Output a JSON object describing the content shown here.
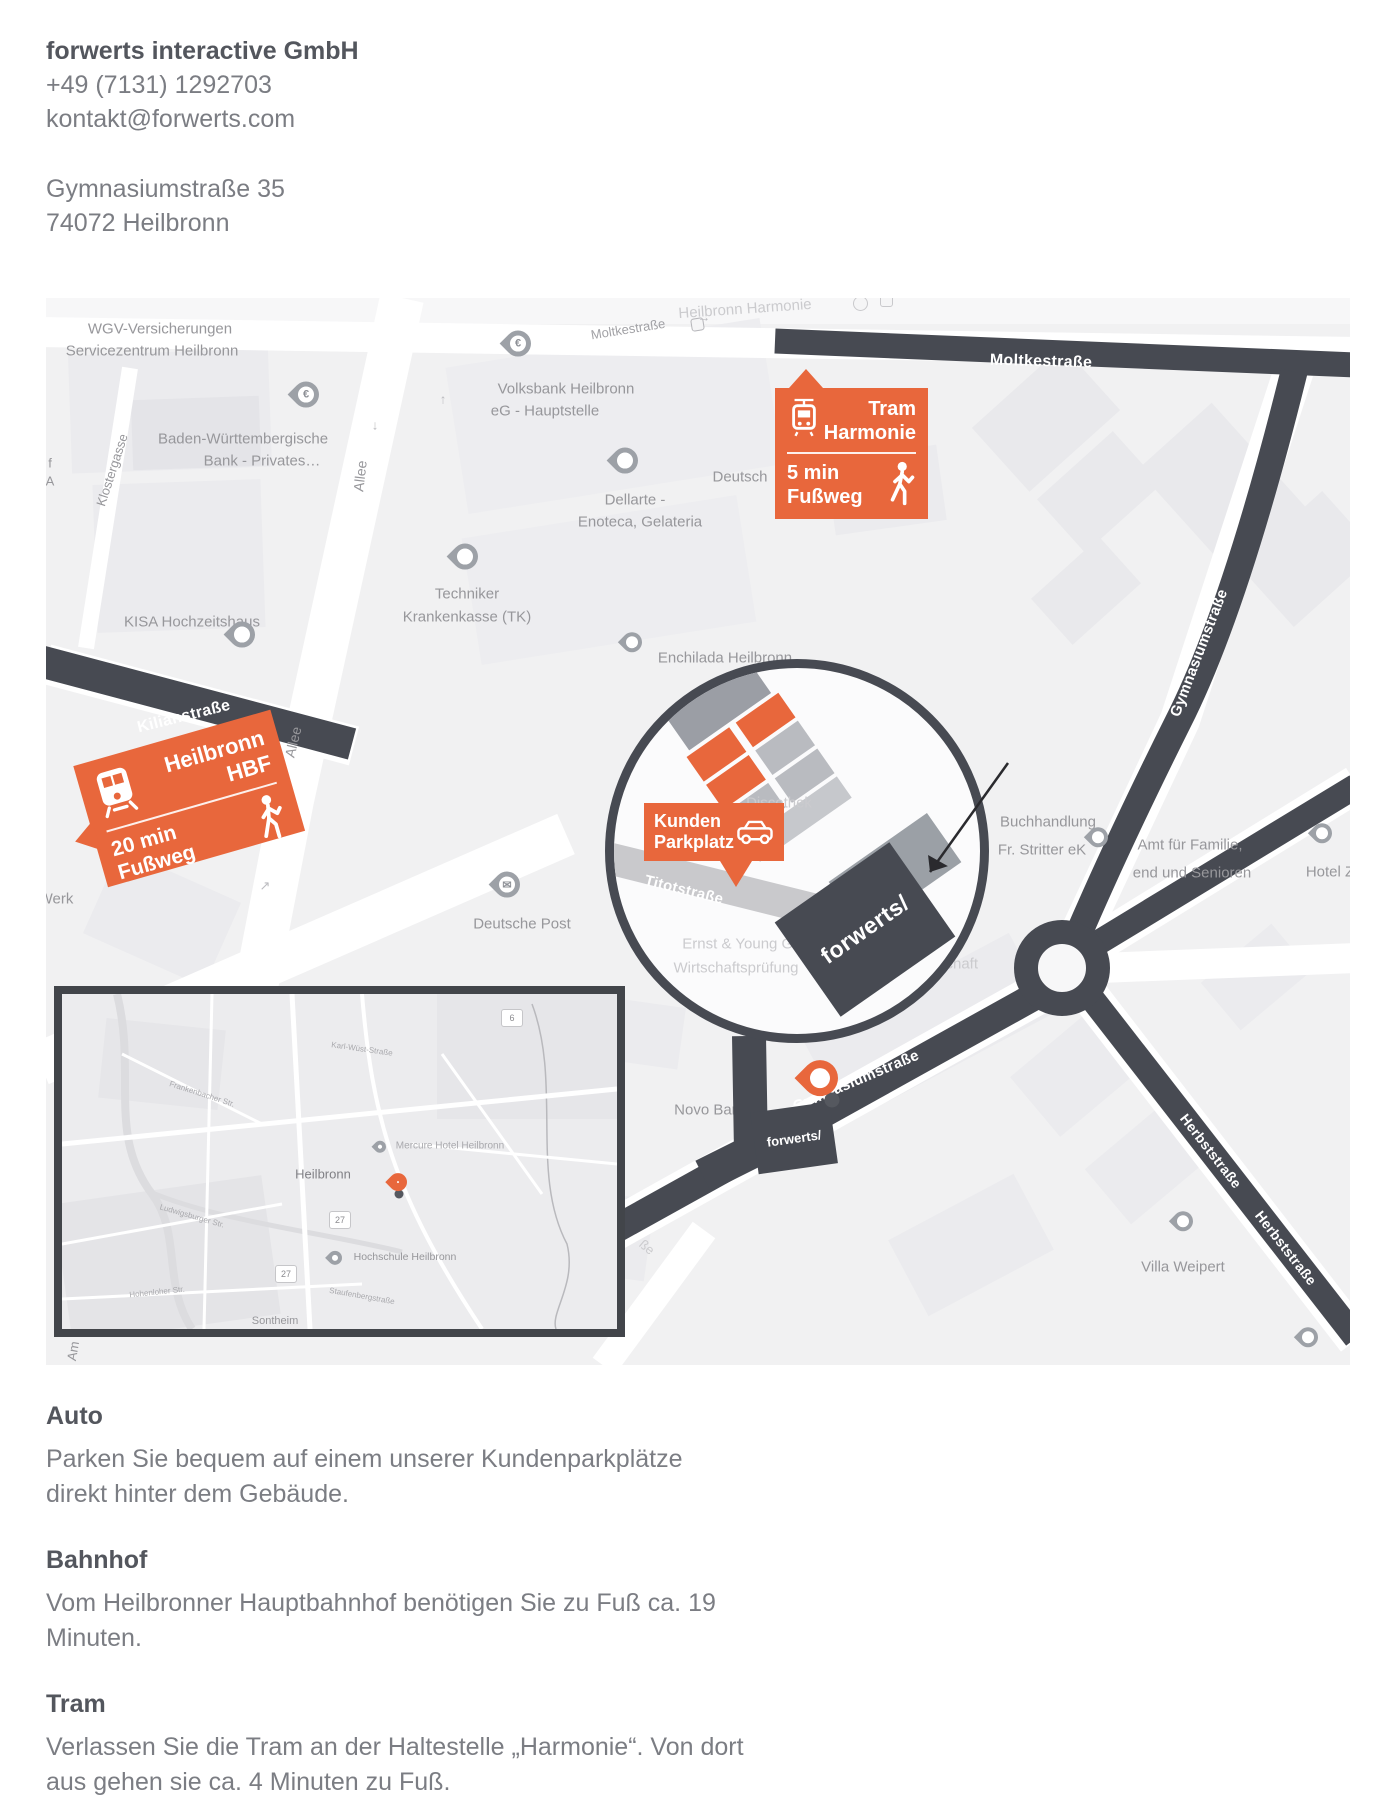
{
  "contact": {
    "company": "forwerts interactive GmbH",
    "phone": "+49 (7131) 1292703",
    "email": "kontakt@forwerts.com",
    "street": "Gymnasiumstraße 35",
    "city": "74072 Heilbronn"
  },
  "callouts": {
    "tram_stop": {
      "line1": "Tram",
      "line2": "Harmonie",
      "walk1": "5 min",
      "walk2": "Fußweg"
    },
    "main_station": {
      "line1": "Heilbronn",
      "line2": "HBF",
      "walk1": "20 min",
      "walk2": "Fußweg"
    },
    "parking": {
      "line1": "Kunden",
      "line2": "Parkplatz"
    }
  },
  "map": {
    "streets": {
      "moltke_band": "Moltkestraße",
      "moltke_small": "Moltkestraße",
      "kilian": "Kilianstraße",
      "gymnasium_upper": "Gymnasiumstraße",
      "gymnasium_lower": "Gymnasiumstraße",
      "titot": "Titotstraße",
      "herbst_upper": "Herbststraße",
      "herbst_lower": "Herbststraße",
      "klostergasse": "Klostergasse",
      "allee_upper": "Allee",
      "allee_lower": "Allee",
      "am_fragment": "Am",
      "sse_fragment": "ße",
      "f_fragment": "f",
      "a_fragment": "A"
    },
    "places": {
      "wgv_line1": "WGV-Versicherungen",
      "wgv_line2": "Servicezentrum Heilbronn",
      "bw_bank_line1": "Baden-Württembergische",
      "bw_bank_line2": "Bank - Privates…",
      "volksbank_line1": "Volksbank Heilbronn",
      "volksbank_line2": "eG - Hauptstelle",
      "kisa": "KISA Hochzeitshaus",
      "tk_line1": "Techniker",
      "tk_line2": "Krankenkasse (TK)",
      "dellarte_line1": "Dellarte -",
      "dellarte_line2": "Enoteca, Gelateria",
      "enchilada": "Enchilada Heilbronn",
      "deutsch_fragment": "Deutsch",
      "post": "Deutsche Post",
      "werk_fragment": "Werk",
      "buchhandlung_line1": "Buchhandlung",
      "buchhandlung_line2": "Fr. Stritter eK",
      "amt_line1": "Amt für Familie,",
      "amt_line2": "end und Senioren",
      "hotel_fragment": "Hotel Z",
      "villa": "Villa Weipert",
      "novo": "Novo Banka",
      "harmonie_ghost": "Heilbronn Harmonie",
      "ey_line1": "Ernst & Young Gm",
      "ey_line2": "Wirtschaftsprüfung",
      "ey_line3": "schaft",
      "disco_ghost": "Discothek"
    },
    "logos": {
      "large_building": "forwerts/",
      "small_building": "forwerts/"
    }
  },
  "inset": {
    "city": "Heilbronn",
    "mercure": "Mercure Hotel Heilbronn",
    "hochschule": "Hochschule Heilbronn",
    "sontheim": "Sontheim",
    "badge_27": "27",
    "badge_6": "6",
    "streets": {
      "frankenbacher": "Frankenbacher Str.",
      "karl_wuest": "Karl-Wüst-Straße",
      "staufenberg": "Staufenbergstraße",
      "ludwigsburger": "Ludwigsburger Str.",
      "hohenloher": "Hohenloher Str."
    }
  },
  "sections": {
    "auto": {
      "title": "Auto",
      "line1": "Parken Sie bequem auf einem unserer Kundenparkplätze",
      "line2": "direkt hinter dem Gebäude."
    },
    "bahnhof": {
      "title": "Bahnhof",
      "line1": "Vom Heilbronner Hauptbahnhof benötigen Sie zu Fuß ca. 19",
      "line2": "Minuten."
    },
    "tram": {
      "title": "Tram",
      "line1": "Verlassen Sie die Tram an der Haltestelle „Harmonie“. Von dort",
      "line2": "aus gehen sie ca. 4 Minuten zu Fuß."
    }
  },
  "colors": {
    "accent": "#E8673C",
    "route": "#474A52",
    "map_label": "#97979B"
  }
}
